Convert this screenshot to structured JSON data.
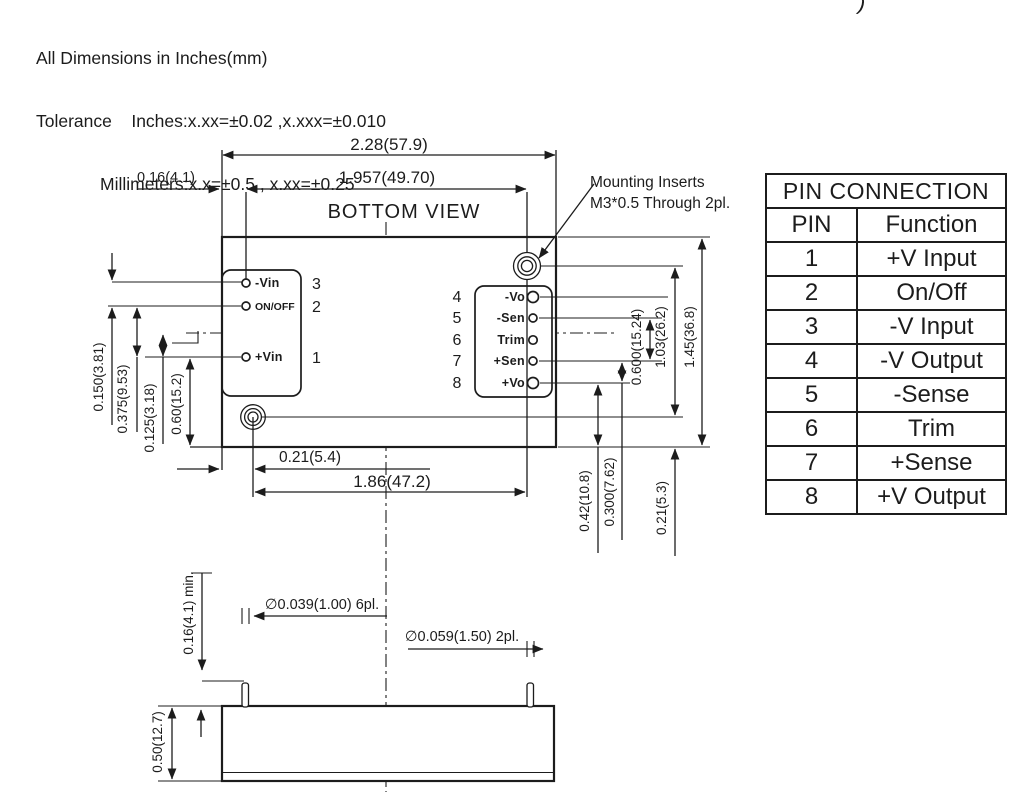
{
  "header": {
    "line1": "All Dimensions in Inches(mm)",
    "line2": "Tolerance    Inches:x.xx=±0.02 ,x.xxx=±0.010",
    "line3": "Millimeters:x.x=±0.5 , x.xx=±0.25",
    "corner_fragment": ")"
  },
  "drawing": {
    "view_label": "BOTTOM VIEW",
    "mounting_note_line1": "Mounting Inserts",
    "mounting_note_line2": "M3*0.5 Through 2pl.",
    "dims": {
      "width_outer": "2.28(57.9)",
      "width_pins": "1.957(49.70)",
      "edge_offset": "0.16(4.1)",
      "left1": "0.150(3.81)",
      "left2": "0.375(9.53)",
      "left3": "0.125(3.18)",
      "left4": "0.60(15.2)",
      "bottom1": "0.21(5.4)",
      "bottom2": "1.86(47.2)",
      "right1": "0.600(15.24)",
      "right2": "1.03(26.2)",
      "right3": "1.45(36.8)",
      "bottom_right1": "0.42(10.8)",
      "bottom_right2": "0.300(7.62)",
      "bottom_right3": "0.21(5.3)"
    },
    "left_pins": [
      {
        "num": "3",
        "label": "-Vin"
      },
      {
        "num": "2",
        "label": "ON/OFF"
      },
      {
        "num": "1",
        "label": "+Vin"
      }
    ],
    "right_pins": [
      {
        "num": "4",
        "label": "-Vo"
      },
      {
        "num": "5",
        "label": "-Sen"
      },
      {
        "num": "6",
        "label": "Trim"
      },
      {
        "num": "7",
        "label": "+Sen"
      },
      {
        "num": "8",
        "label": "+Vo"
      }
    ],
    "side_view": {
      "dim_standoff": "0.16(4.1) min.",
      "dim_pin_dia": "∅0.039(1.00) 6pl.",
      "dim_insert_dia": "∅0.059(1.50) 2pl.",
      "dim_height": "0.50(12.7)"
    }
  },
  "pin_table": {
    "title": "PIN CONNECTION",
    "columns": [
      "PIN",
      "Function"
    ],
    "rows": [
      [
        "1",
        "+V Input"
      ],
      [
        "2",
        "On/Off"
      ],
      [
        "3",
        "-V Input"
      ],
      [
        "4",
        "-V Output"
      ],
      [
        "5",
        "-Sense"
      ],
      [
        "6",
        "Trim"
      ],
      [
        "7",
        "+Sense"
      ],
      [
        "8",
        "+V Output"
      ]
    ]
  }
}
